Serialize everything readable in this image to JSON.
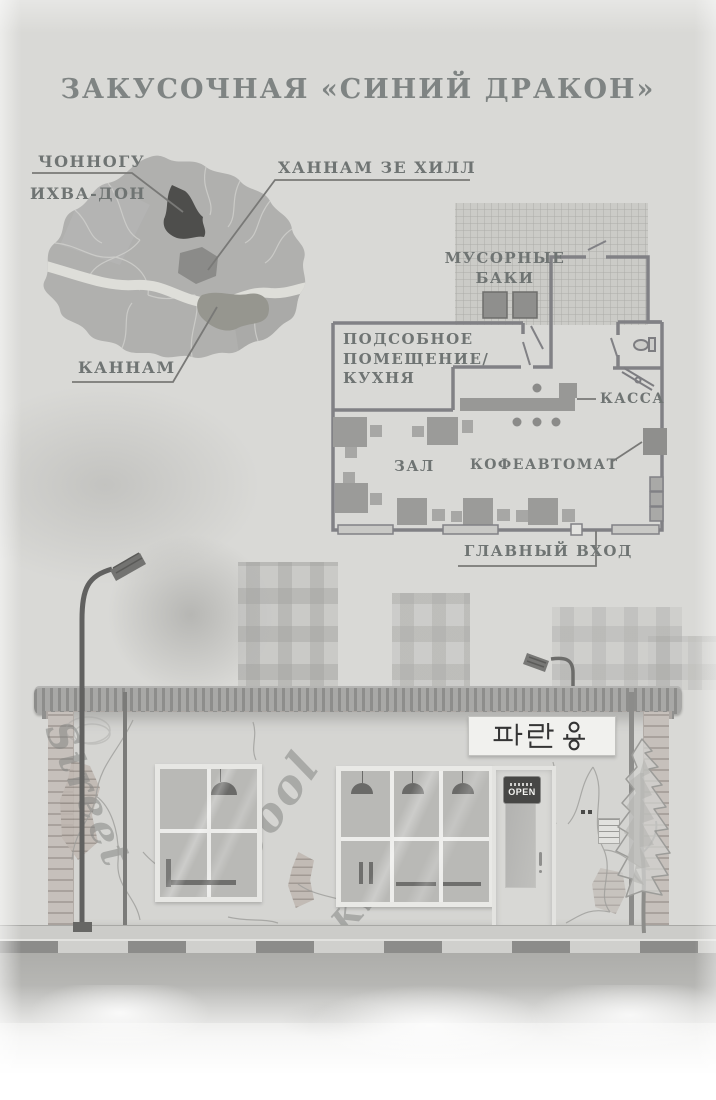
{
  "page": {
    "title": "ЗАКУСОЧНАЯ «СИНИЙ ДРАКОН»"
  },
  "map": {
    "label_jongno": "ЧОННОГУ",
    "label_ihwa": "ИХВА-ДОН",
    "label_hannam": "ХАННАМ ЗЕ ХИЛЛ",
    "label_gangnam": "КАННАМ"
  },
  "floorplan": {
    "label_trash": "МУСОРНЫЕ БАКИ",
    "kitchen_line1": "ПОДСОБНОЕ",
    "kitchen_line2": "ПОМЕЩЕНИЕ/",
    "kitchen_line3": "КУХНЯ",
    "label_cashier": "КАССА",
    "label_hall": "ЗАЛ",
    "label_coffee": "КОФЕАВТОМАТ",
    "label_entrance": "ГЛАВНЫЙ ВХОД"
  },
  "facade": {
    "sign_korean": "파란 용",
    "door_sign_open": "OPEN",
    "graffiti_street": "Street",
    "graffiti_cool": "Cool",
    "graffiti_king": "King"
  },
  "colors": {
    "paper": "#d9d9d6",
    "ink": "#6f7473",
    "district_dark": "#4e4e4c",
    "district_medium": "#8b8b89",
    "district_gangnam": "#96968f",
    "plan_wall": "#818185",
    "sign_bg": "#f1f1ee",
    "open_sign_bg": "#474745"
  }
}
